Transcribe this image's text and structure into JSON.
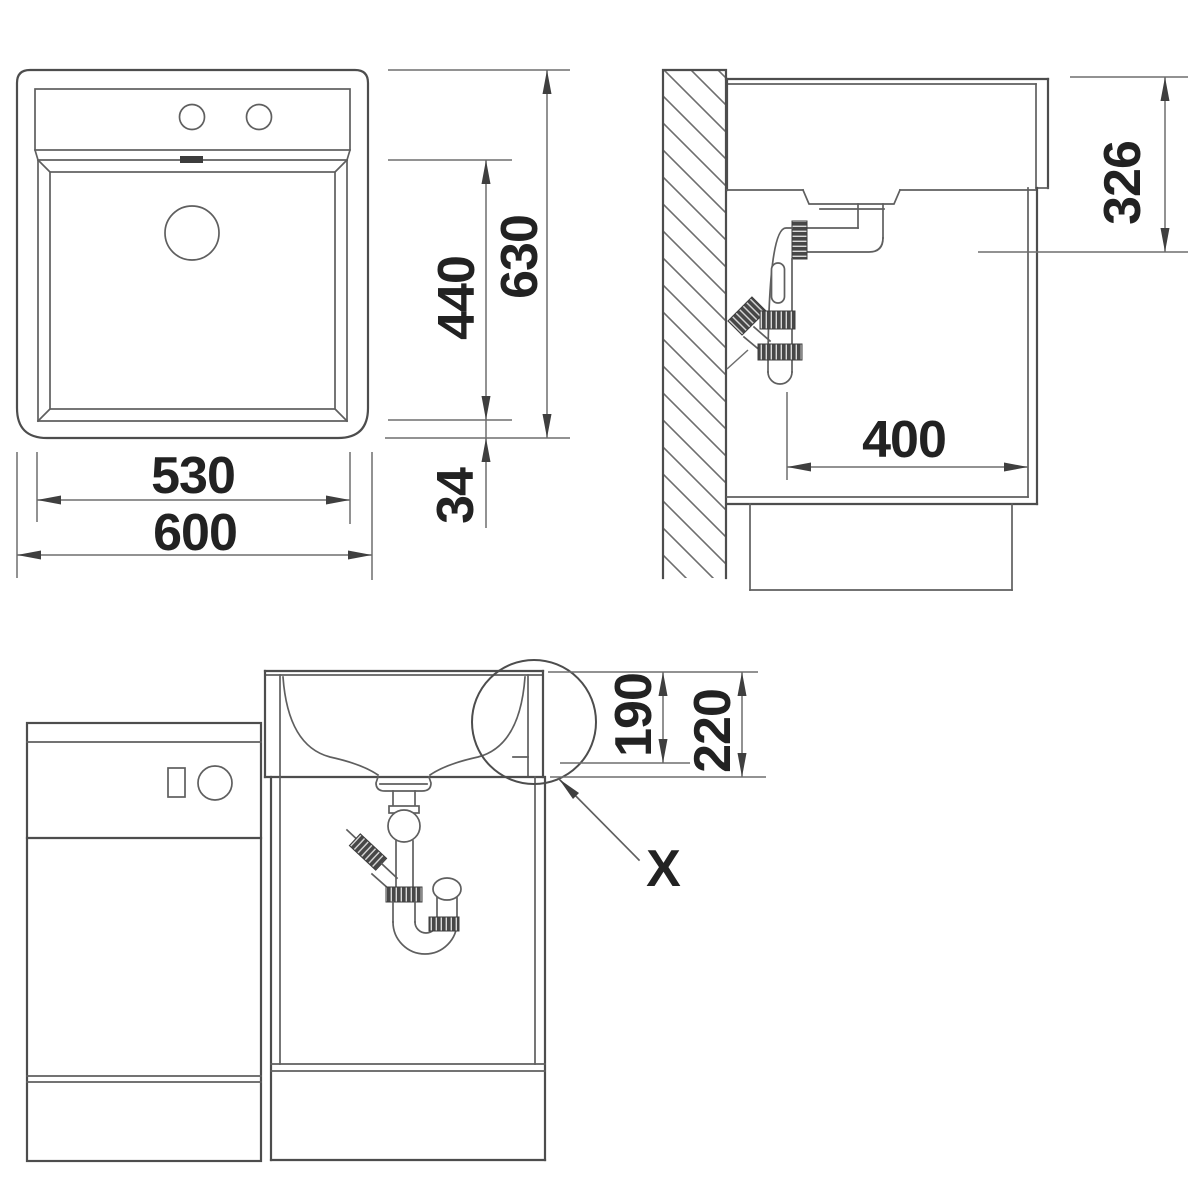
{
  "drawing": {
    "kind": "sink installation dimensional drawing",
    "front_view": {
      "bowl_width_mm": "530",
      "overall_width_mm": "600",
      "bowl_depth_mm": "440",
      "overall_depth_mm": "630",
      "rim_offset_mm": "34"
    },
    "side_view": {
      "mounting_height_mm": "326",
      "drain_distance_mm": "400"
    },
    "installed_view": {
      "bowl_inner_height_mm": "190",
      "overall_height_mm": "220",
      "detail_label": "X"
    },
    "colors": {
      "line": "#4d4d4d",
      "dimension_line": "#6e6e6e",
      "text": "#222222",
      "background": "#ffffff"
    }
  }
}
